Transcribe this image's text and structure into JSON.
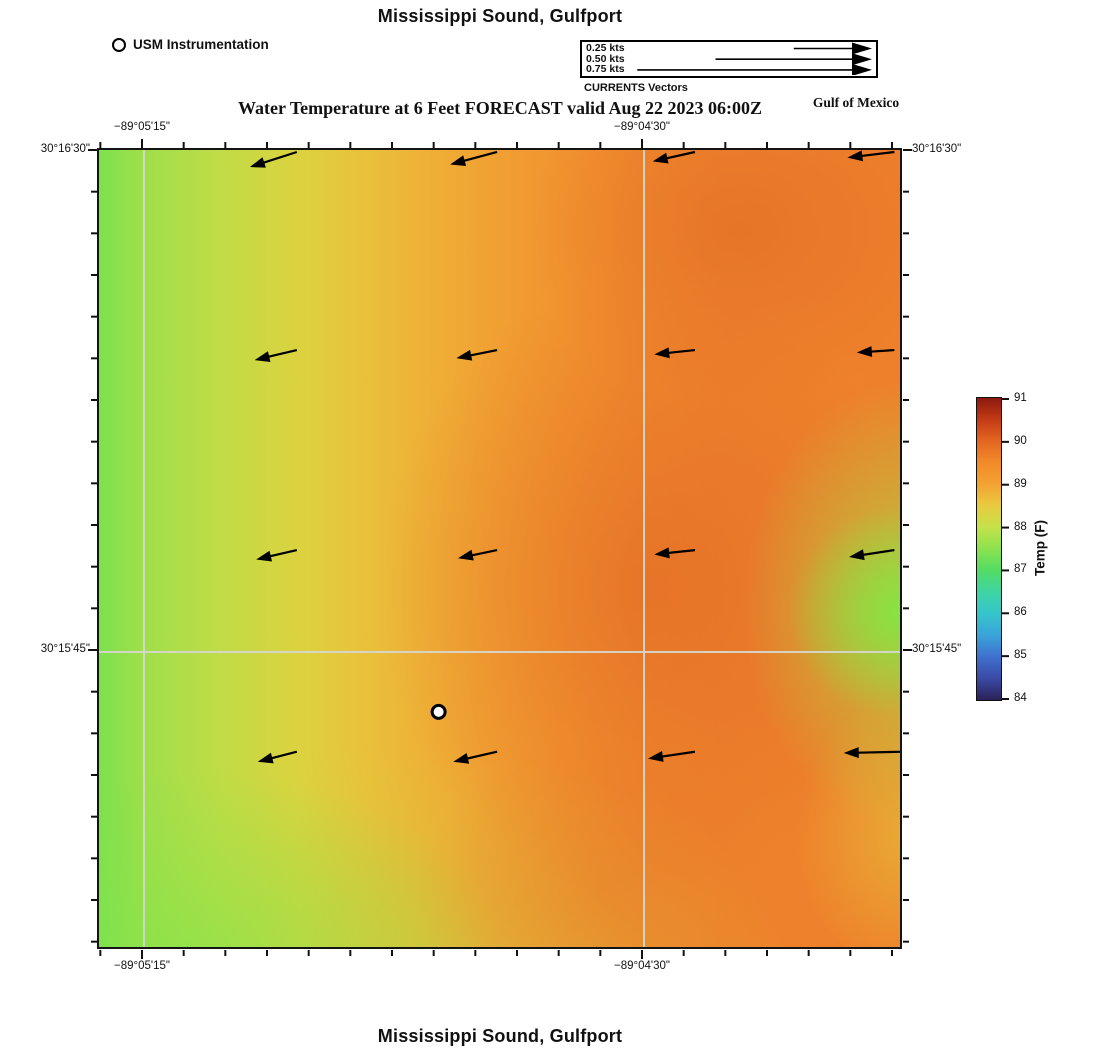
{
  "titles": {
    "top": "Mississippi Sound, Gulfport",
    "forecast": "Water Temperature at 6 Feet FORECAST valid Aug 22 2023 06:00Z",
    "region_label": "Gulf of Mexico",
    "bottom": "Mississippi Sound, Gulfport"
  },
  "station_legend": {
    "label": "USM Instrumentation"
  },
  "currents_legend": {
    "caption": "CURRENTS Vectors",
    "entries": [
      {
        "label": "0.25 kts",
        "speed_kts": 0.25
      },
      {
        "label": "0.50 kts",
        "speed_kts": 0.5
      },
      {
        "label": "0.75 kts",
        "speed_kts": 0.75
      }
    ]
  },
  "axes": {
    "lon_labels": [
      "−89°05'15\"",
      "−89°04'30\""
    ],
    "lat_labels": [
      "30°16'30\"",
      "30°15'45\""
    ]
  },
  "chart_data": {
    "type": "heatmap",
    "title": "Water Temperature at 6 Feet FORECAST valid Aug 22 2023 06:00Z",
    "location": "Mississippi Sound, Gulfport",
    "depth": "6 Feet",
    "valid_time": "Aug 22 2023 06:00Z",
    "lon_gridlines": [
      "−89°05'15\"",
      "−89°04'30\""
    ],
    "lat_gridlines": [
      "30°16'30\"",
      "30°15'45\""
    ],
    "colorbar": {
      "label": "Temp (F)",
      "min": 84,
      "max": 91,
      "ticks": [
        91,
        90,
        89,
        88,
        87,
        86,
        85,
        84
      ],
      "stops": [
        {
          "t": 84.0,
          "c": "#2a2158"
        },
        {
          "t": 84.5,
          "c": "#3a4aa5"
        },
        {
          "t": 85.0,
          "c": "#3f70cf"
        },
        {
          "t": 85.5,
          "c": "#3aa3da"
        },
        {
          "t": 86.0,
          "c": "#36c5cb"
        },
        {
          "t": 86.5,
          "c": "#3fd4a4"
        },
        {
          "t": 87.0,
          "c": "#52dc64"
        },
        {
          "t": 87.5,
          "c": "#8be24f"
        },
        {
          "t": 88.0,
          "c": "#c4e24a"
        },
        {
          "t": 88.5,
          "c": "#e9cb3f"
        },
        {
          "t": 89.0,
          "c": "#f4a233"
        },
        {
          "t": 89.5,
          "c": "#f18b2a"
        },
        {
          "t": 90.0,
          "c": "#e36620"
        },
        {
          "t": 90.5,
          "c": "#c33b16"
        },
        {
          "t": 91.0,
          "c": "#8c190f"
        }
      ]
    },
    "temperature_grid_F": {
      "note": "approximate values read from color field; rows north to south, cols west to east",
      "values": [
        [
          87.6,
          88.3,
          88.9,
          89.4,
          89.4
        ],
        [
          87.5,
          88.4,
          89.0,
          89.6,
          89.0
        ],
        [
          87.5,
          88.5,
          89.3,
          89.6,
          87.9
        ],
        [
          87.4,
          88.4,
          89.2,
          89.3,
          88.3
        ],
        [
          87.3,
          88.0,
          89.0,
          89.2,
          88.6
        ]
      ]
    },
    "current_vectors": {
      "scale_px_per_kt": 313,
      "grid": [
        {
          "x_frac": 0.247,
          "y_frac": 0.0025,
          "u_kts": -0.15,
          "v_kts": -0.048
        },
        {
          "x_frac": 0.497,
          "y_frac": 0.0025,
          "u_kts": -0.15,
          "v_kts": -0.04
        },
        {
          "x_frac": 0.744,
          "y_frac": 0.0025,
          "u_kts": -0.135,
          "v_kts": -0.03
        },
        {
          "x_frac": 0.993,
          "y_frac": 0.0025,
          "u_kts": -0.15,
          "v_kts": -0.018
        },
        {
          "x_frac": 0.247,
          "y_frac": 0.251,
          "u_kts": -0.135,
          "v_kts": -0.032
        },
        {
          "x_frac": 0.497,
          "y_frac": 0.251,
          "u_kts": -0.13,
          "v_kts": -0.026
        },
        {
          "x_frac": 0.744,
          "y_frac": 0.251,
          "u_kts": -0.13,
          "v_kts": -0.014
        },
        {
          "x_frac": 0.993,
          "y_frac": 0.251,
          "u_kts": -0.12,
          "v_kts": -0.008
        },
        {
          "x_frac": 0.247,
          "y_frac": 0.502,
          "u_kts": -0.13,
          "v_kts": -0.03
        },
        {
          "x_frac": 0.497,
          "y_frac": 0.502,
          "u_kts": -0.125,
          "v_kts": -0.026
        },
        {
          "x_frac": 0.744,
          "y_frac": 0.502,
          "u_kts": -0.13,
          "v_kts": -0.014
        },
        {
          "x_frac": 0.993,
          "y_frac": 0.502,
          "u_kts": -0.145,
          "v_kts": -0.022
        },
        {
          "x_frac": 0.247,
          "y_frac": 0.755,
          "u_kts": -0.125,
          "v_kts": -0.032
        },
        {
          "x_frac": 0.497,
          "y_frac": 0.755,
          "u_kts": -0.14,
          "v_kts": -0.032
        },
        {
          "x_frac": 0.744,
          "y_frac": 0.755,
          "u_kts": -0.15,
          "v_kts": -0.022
        },
        {
          "x_frac": 1.004,
          "y_frac": 0.755,
          "u_kts": -0.19,
          "v_kts": -0.004
        }
      ]
    },
    "station": {
      "name": "USM Instrumentation",
      "x_frac": 0.424,
      "y_frac": 0.705
    }
  }
}
